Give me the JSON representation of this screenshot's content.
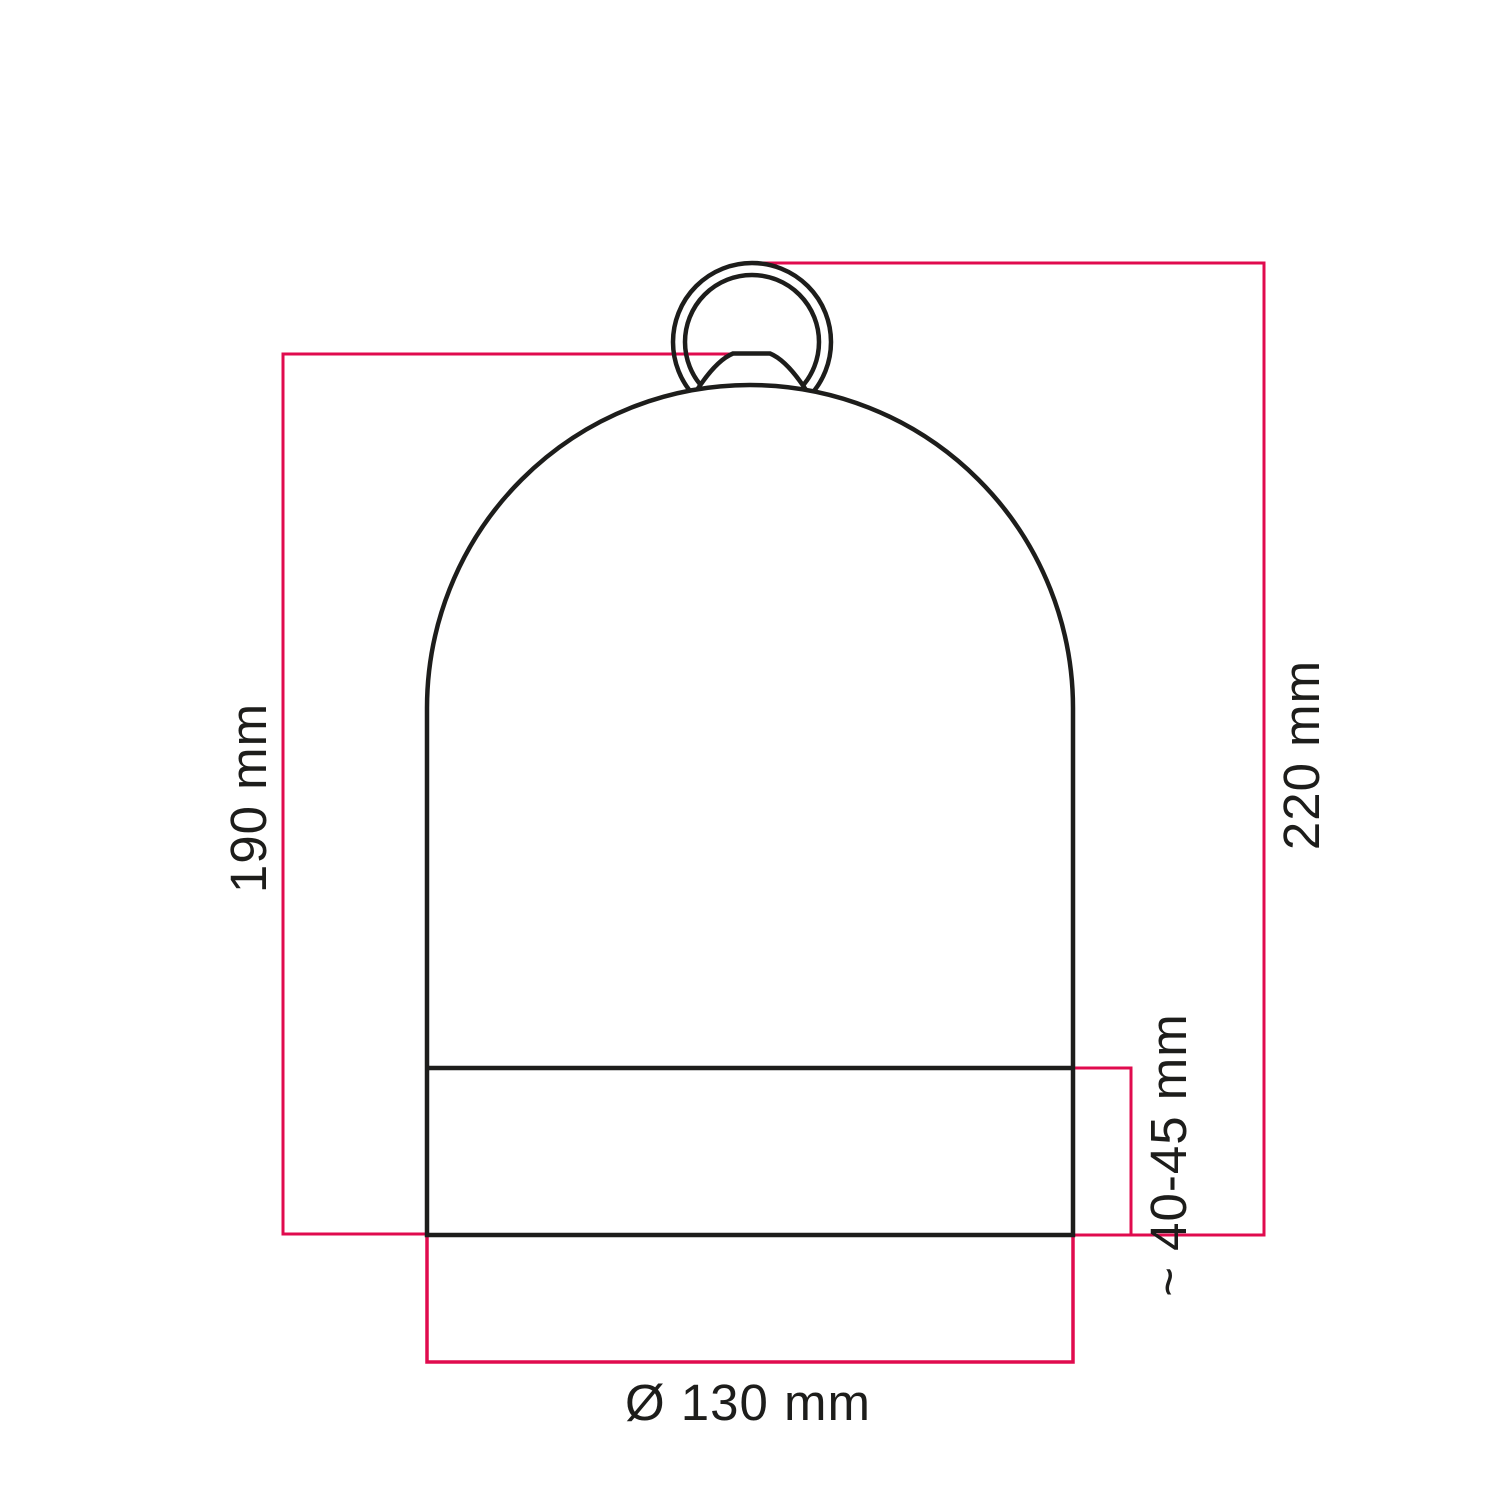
{
  "drawing": {
    "type": "technical-dimension-drawing",
    "subject": "bell-shaped lampshade with hanging ring",
    "labels": {
      "height_inner": "190 mm",
      "height_total": "220 mm",
      "base_height": "~ 40-45 mm",
      "diameter": "Ø 130 mm"
    },
    "colors": {
      "dimension_line": "#e00b4e",
      "outline": "#1d1d1b",
      "text": "#1d1d1b",
      "background": "#ffffff"
    }
  }
}
